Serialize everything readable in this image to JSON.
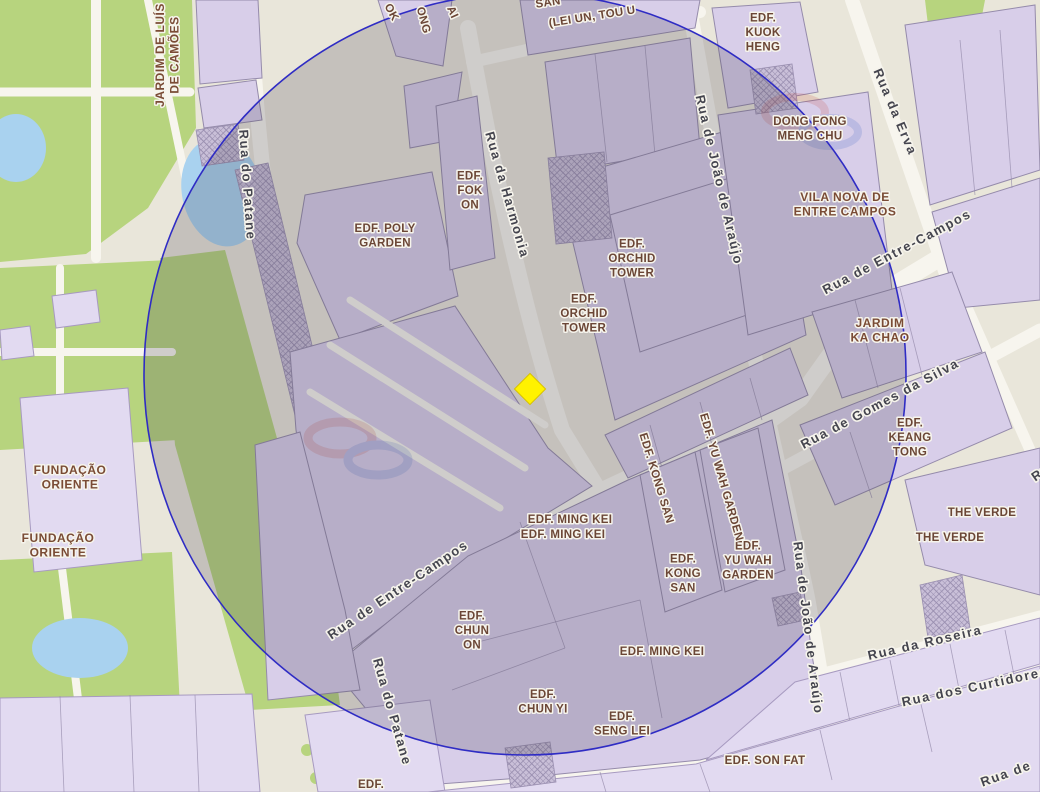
{
  "map_title": "Macau buffer map",
  "colors": {
    "circle_stroke": "#2f2cc4",
    "circle_fill": "rgba(70,62,82,0.22)",
    "marker": "#fff200",
    "building_label": "#6b4636",
    "street_label": "#45454f",
    "park_green": "#b7d47e",
    "water": "#a9d2ef",
    "building_fill": "#d8cee9"
  },
  "overlay_circle": {
    "cx": 525,
    "cy": 374,
    "r": 381
  },
  "marker": {
    "shape": "diamond",
    "color": "#fff200",
    "x": 530,
    "y": 389
  },
  "labels": {
    "area": [
      {
        "lines": [
          "JARDIM DE LUÍS",
          "DE CAMÕES"
        ],
        "x": 167,
        "y": 55,
        "rot": -90
      },
      {
        "lines": [
          "FUNDAÇÃO",
          "ORIENTE"
        ],
        "x": 70,
        "y": 477
      },
      {
        "lines": [
          "FUNDAÇÃO",
          "ORIENTE"
        ],
        "x": 58,
        "y": 545
      },
      {
        "lines": [
          "VILA NOVA DE",
          "ENTRE CAMPOS"
        ],
        "x": 845,
        "y": 204
      },
      {
        "lines": [
          "JARDIM",
          "KA CHAO"
        ],
        "x": 880,
        "y": 330
      }
    ],
    "building": [
      {
        "lines": [
          "EDF. POLY",
          "GARDEN"
        ],
        "x": 385,
        "y": 235
      },
      {
        "lines": [
          "EDF.",
          "FOK",
          "ON"
        ],
        "x": 470,
        "y": 190
      },
      {
        "lines": [
          "EDF.",
          "ORCHID",
          "TOWER"
        ],
        "x": 632,
        "y": 258
      },
      {
        "lines": [
          "EDF.",
          "ORCHID",
          "TOWER"
        ],
        "x": 584,
        "y": 313
      },
      {
        "lines": [
          "EDF.",
          "KUOK",
          "HENG"
        ],
        "x": 763,
        "y": 32
      },
      {
        "lines": [
          "DONG FONG",
          "MENG CHU"
        ],
        "x": 810,
        "y": 128
      },
      {
        "lines": [
          "EDF.",
          "KEANG",
          "TONG"
        ],
        "x": 910,
        "y": 437
      },
      {
        "text": "THE VERDE",
        "x": 982,
        "y": 512
      },
      {
        "text": "THE VERDE",
        "x": 950,
        "y": 537
      },
      {
        "lines": [
          "EDF.",
          "YU WAH",
          "GARDEN"
        ],
        "x": 748,
        "y": 560
      },
      {
        "lines": [
          "EDF.",
          "KONG",
          "SAN"
        ],
        "x": 683,
        "y": 573
      },
      {
        "text": "EDF. KONG SAN",
        "x": 657,
        "y": 478,
        "rot": 73
      },
      {
        "text": "EDF. YU WAH GARDEN",
        "x": 722,
        "y": 477,
        "rot": 74
      },
      {
        "text": "EDF. MING KEI",
        "x": 570,
        "y": 519
      },
      {
        "text": "EDF. MING KEI",
        "x": 563,
        "y": 534
      },
      {
        "text": "EDF. MING KEI",
        "x": 662,
        "y": 651
      },
      {
        "lines": [
          "EDF.",
          "CHUN",
          "ON"
        ],
        "x": 472,
        "y": 630
      },
      {
        "lines": [
          "EDF.",
          "CHUN YI"
        ],
        "x": 543,
        "y": 701
      },
      {
        "lines": [
          "EDF.",
          "SENG LEI"
        ],
        "x": 622,
        "y": 723
      },
      {
        "text": "EDF. SON FAT",
        "x": 765,
        "y": 760
      },
      {
        "text": "EDF.",
        "x": 371,
        "y": 784
      },
      {
        "text": "OK",
        "x": 392,
        "y": 12,
        "rot": 62
      },
      {
        "text": "ONG",
        "x": 424,
        "y": 20,
        "rot": 75
      },
      {
        "text": "AI",
        "x": 453,
        "y": 12,
        "rot": 66
      },
      {
        "text": "SAN",
        "x": 548,
        "y": 2,
        "rot": -9
      },
      {
        "text": "(LEI UN, TOU U",
        "x": 592,
        "y": 16,
        "rot": -9
      }
    ],
    "street": [
      {
        "text": "Rua do Patane",
        "x": 247,
        "y": 185,
        "rot": 86
      },
      {
        "text": "Rua do Patane",
        "x": 392,
        "y": 712,
        "rot": 74
      },
      {
        "text": "Rua da Harmonia",
        "x": 507,
        "y": 195,
        "rot": 74
      },
      {
        "text": "Rua de João de Araújo",
        "x": 719,
        "y": 180,
        "rot": 77
      },
      {
        "text": "Rua de João de Araújo",
        "x": 808,
        "y": 628,
        "rot": 83
      },
      {
        "text": "Rua da Erva",
        "x": 895,
        "y": 112,
        "rot": 67
      },
      {
        "text": "Rua de Entre-Campos",
        "x": 897,
        "y": 252,
        "rot": -28
      },
      {
        "text": "Rua de Entre-Campos",
        "x": 398,
        "y": 590,
        "rot": -34
      },
      {
        "text": "Rua de Gomes da Silva",
        "x": 880,
        "y": 404,
        "rot": -28
      },
      {
        "text": "Rua da Roseira",
        "x": 925,
        "y": 643,
        "rot": -13
      },
      {
        "text": "Rua dos Curtidores",
        "x": 975,
        "y": 687,
        "rot": -12
      },
      {
        "text": "Rua de",
        "x": 1006,
        "y": 774,
        "rot": -20
      },
      {
        "text": "Rua",
        "x": 1045,
        "y": 470,
        "rot": -35
      }
    ]
  }
}
